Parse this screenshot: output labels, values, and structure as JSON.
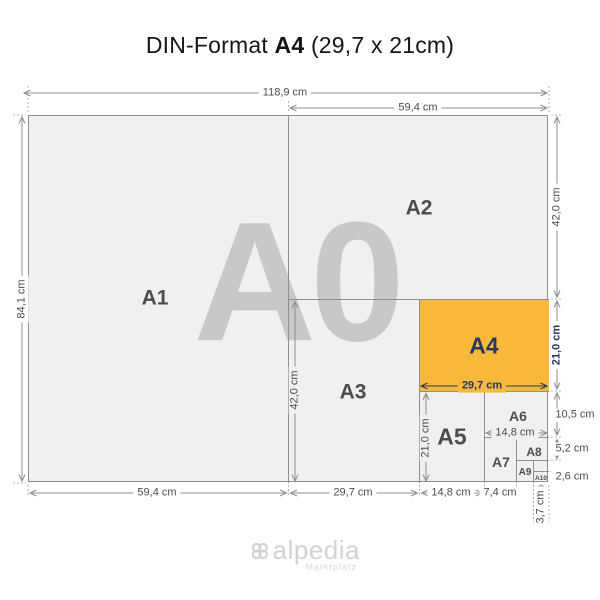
{
  "title": {
    "prefix": "DIN-Format ",
    "emphasis": "A4",
    "suffix": " (29,7 x 21cm)"
  },
  "watermark": "A0",
  "labels": {
    "a1": "A1",
    "a2": "A2",
    "a3": "A3",
    "a4": "A4",
    "a5": "A5",
    "a6": "A6",
    "a7": "A7",
    "a8": "A8",
    "a9": "A9",
    "a10": "A10"
  },
  "dims": {
    "a0_width": "118,9 cm",
    "a2_width": "59,4 cm",
    "a0_height": "84,1 cm",
    "a2_height": "42,0 cm",
    "a4_height": "21,0 cm",
    "a6_height": "10,5 cm",
    "a8_height": "5,2 cm",
    "a10_height": "2,6 cm",
    "a3_height": "42,0 cm",
    "a5_height": "21,0 cm",
    "a4_width": "29,7 cm",
    "a6_width": "14,8 cm",
    "a1_width": "59,4 cm",
    "a3_width": "29,7 cm",
    "a5_width": "14,8 cm",
    "a7_width": "7,4 cm",
    "a10_width": "3,7 cm"
  },
  "footer": {
    "brand": "alpedia",
    "tagline": "Marktplatz"
  },
  "colors": {
    "highlight": "#F8B83B",
    "accent": "#263A5E",
    "paper": "#f0f0f0"
  }
}
